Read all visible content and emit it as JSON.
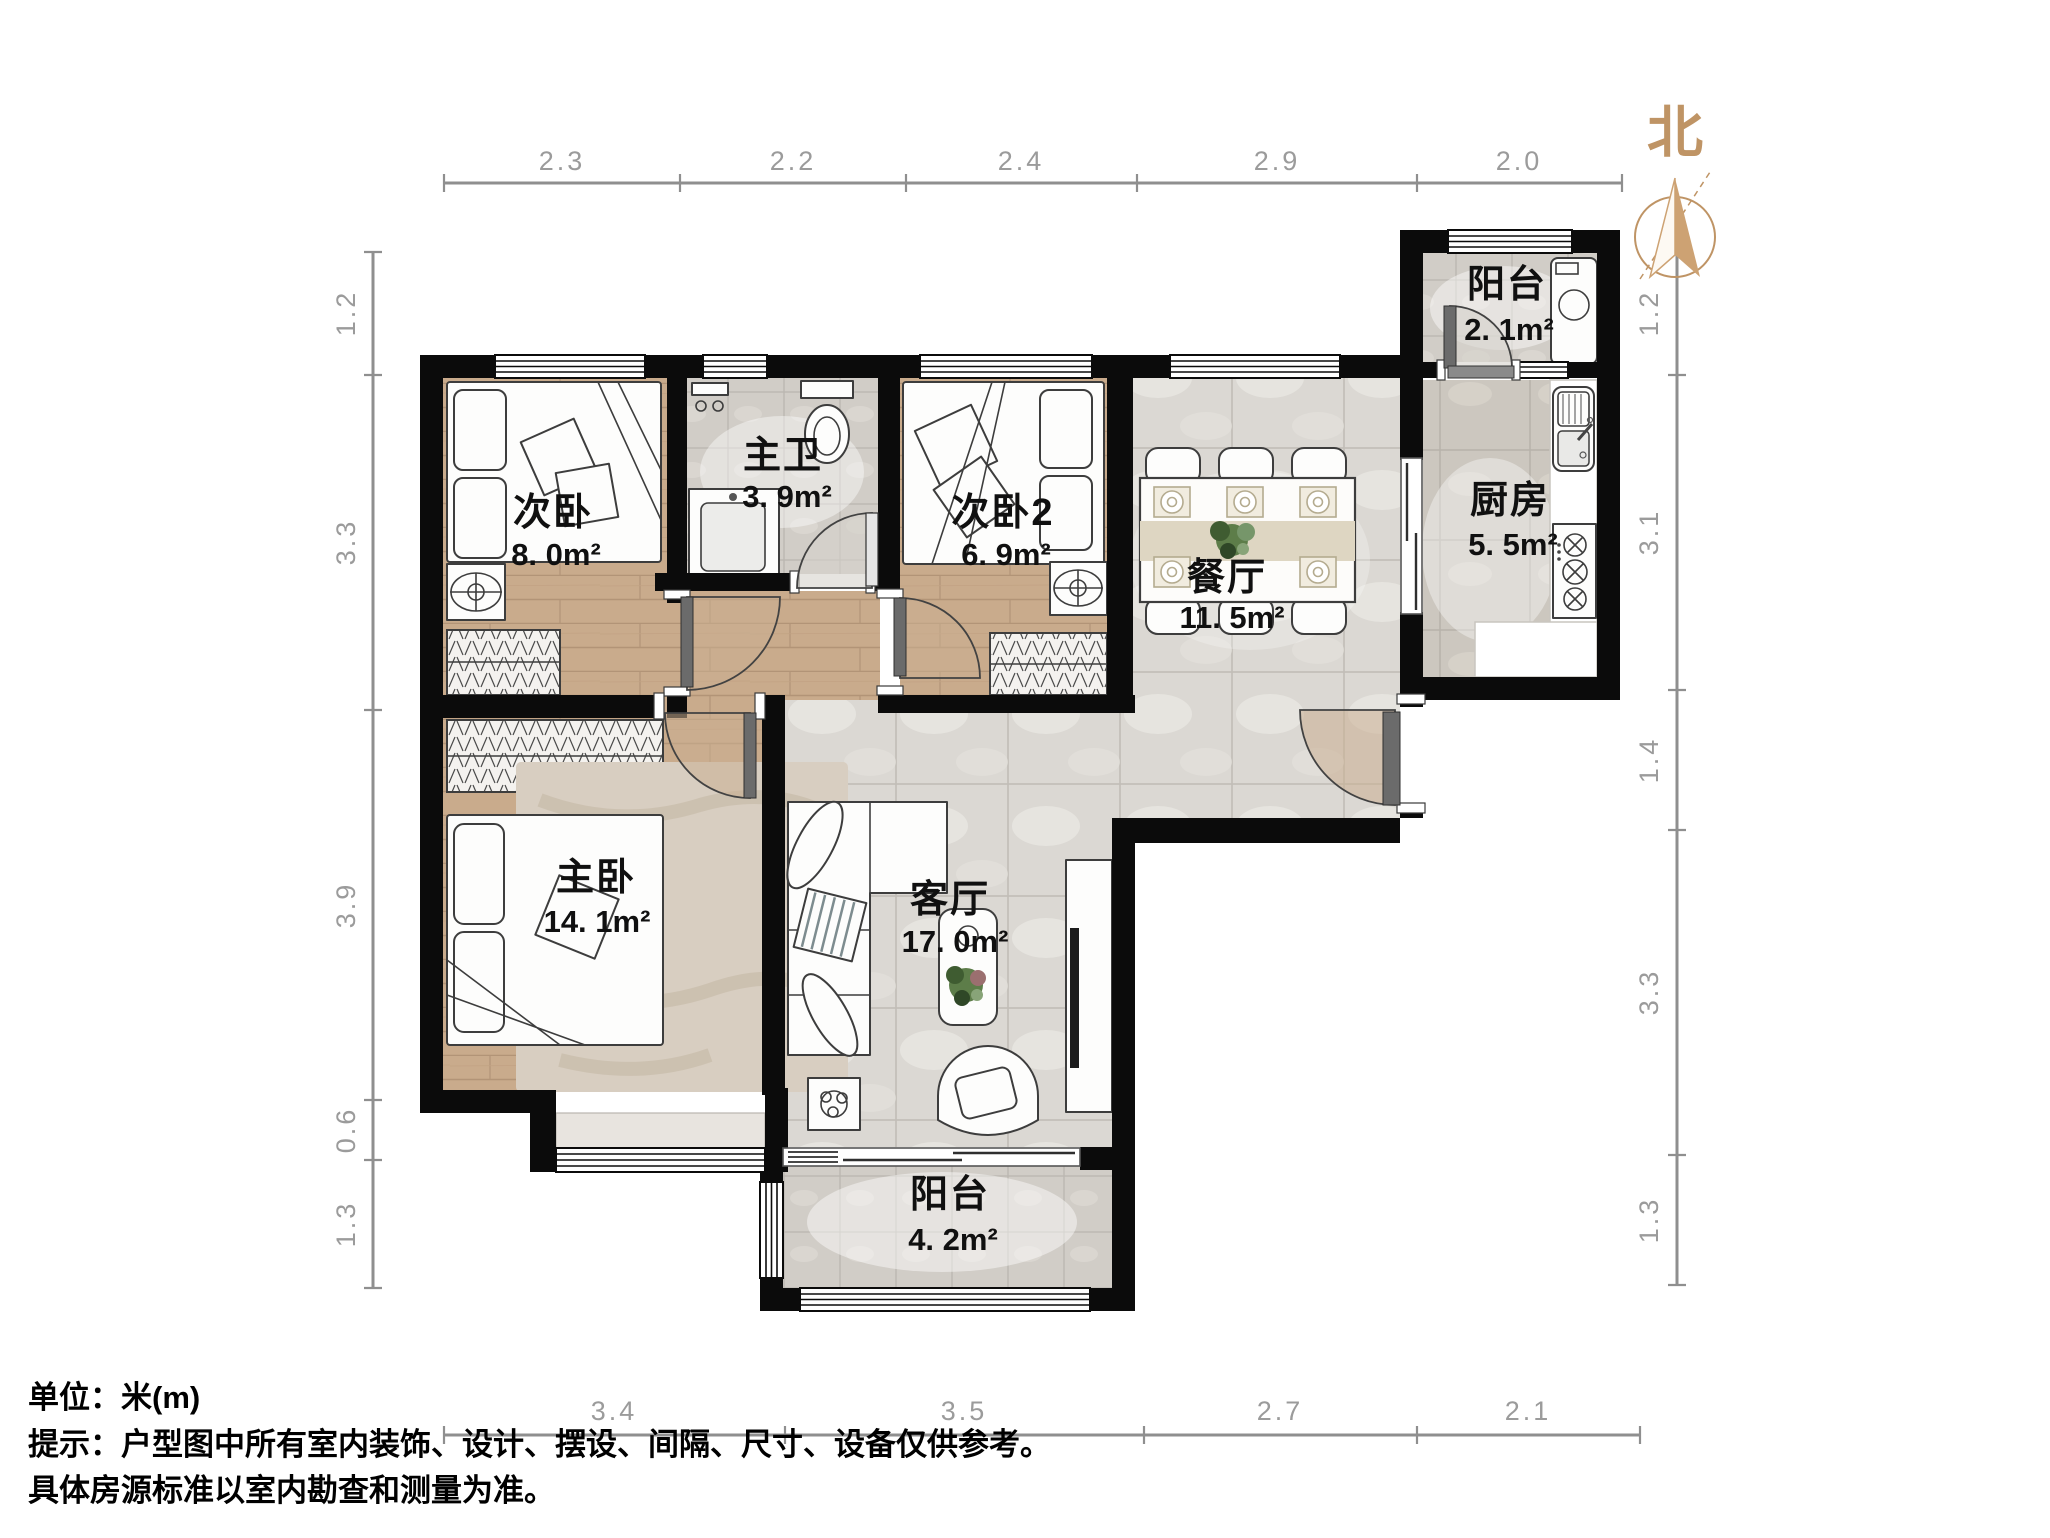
{
  "compass": {
    "north_label": "北"
  },
  "rooms": {
    "bedroom2": {
      "name": "次卧",
      "area": "8. 0m²"
    },
    "bathroom": {
      "name": "主卫",
      "area": "3. 9m²"
    },
    "bedroom3": {
      "name": "次卧2",
      "area": "6. 9m²"
    },
    "dining": {
      "name": "餐厅",
      "area": "11. 5m²"
    },
    "kitchen": {
      "name": "厨房",
      "area": "5. 5m²"
    },
    "balcony_north": {
      "name": "阳台",
      "area": "2. 1m²"
    },
    "master": {
      "name": "主卧",
      "area": "14. 1m²"
    },
    "living": {
      "name": "客厅",
      "area": "17. 0m²"
    },
    "balcony_south": {
      "name": "阳台",
      "area": "4. 2m²"
    }
  },
  "dimensions": {
    "top": [
      "2.3",
      "2.2",
      "2.4",
      "2.9",
      "2.0"
    ],
    "bottom": [
      "3.4",
      "3.5",
      "2.7",
      "2.1"
    ],
    "left": [
      "1.2",
      "3.3",
      "3.9",
      "0.6",
      "1.3"
    ],
    "right": [
      "1.2",
      "3.1",
      "1.4",
      "3.3",
      "1.3"
    ]
  },
  "footer": {
    "line1": "单位：米(m)",
    "line2": "提示：户型图中所有室内装饰、设计、摆设、间隔、尺寸、设备仅供参考。",
    "line3": "具体房源标准以室内勘查和测量为准。"
  },
  "colors": {
    "wall": "#0b0b0b",
    "wood_floor": "#c9ab8c",
    "tile_floor": "#dbd8d3",
    "dimension": "#9b9b9b",
    "north_accent": "#bf9465"
  }
}
